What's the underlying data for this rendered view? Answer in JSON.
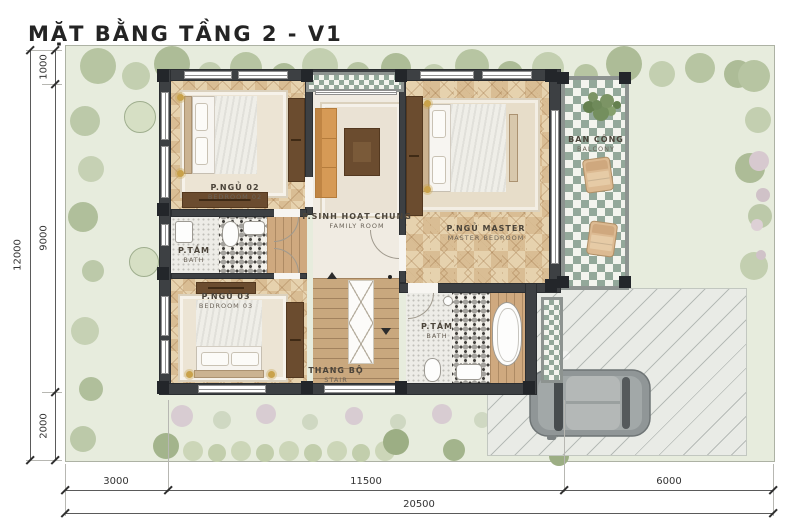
{
  "title": "MẶT BẰNG TẦNG 2 - V1",
  "rooms": {
    "bedroom02": {
      "name": "P.NGỦ 02",
      "en": "BEDROOM 02"
    },
    "bath1": {
      "name": "P.TẮM",
      "en": "BATH"
    },
    "bedroom03": {
      "name": "P.NGỦ 03",
      "en": "BEDROOM 03"
    },
    "family": {
      "name": "P.SINH HOẠT CHUNG",
      "en": "FAMILY ROOM"
    },
    "master": {
      "name": "P.NGỦ MASTER",
      "en": "MASTER BEDROOM"
    },
    "balcony": {
      "name": "BAN CÔNG",
      "en": "BALCONY"
    },
    "stair": {
      "name": "THANG BỘ",
      "en": "STAIR"
    },
    "bath2": {
      "name": "P.TẮM",
      "en": "BATH"
    }
  },
  "dimensions": {
    "left": {
      "total": "12000",
      "segments": [
        "1000",
        "9000",
        "2000"
      ]
    },
    "bottom": {
      "total": "20500",
      "segments": [
        "3000",
        "11500",
        "6000"
      ]
    }
  },
  "colors": {
    "wall": "#3d4043",
    "wood_dark": "#6b4c2f",
    "wood_mid": "#c9a87e",
    "floor_wood": "#e6d2ae",
    "floor_light": "#f0ebe2",
    "checker_green": "#93a89a",
    "checker_bg": "#f3f4ee",
    "sofa": "#d69a56",
    "grass": "#e7ecdd",
    "paving": "#e9ebe6",
    "label": "#4b443a",
    "dim": "#333333",
    "tree": "#bcc9a9"
  }
}
